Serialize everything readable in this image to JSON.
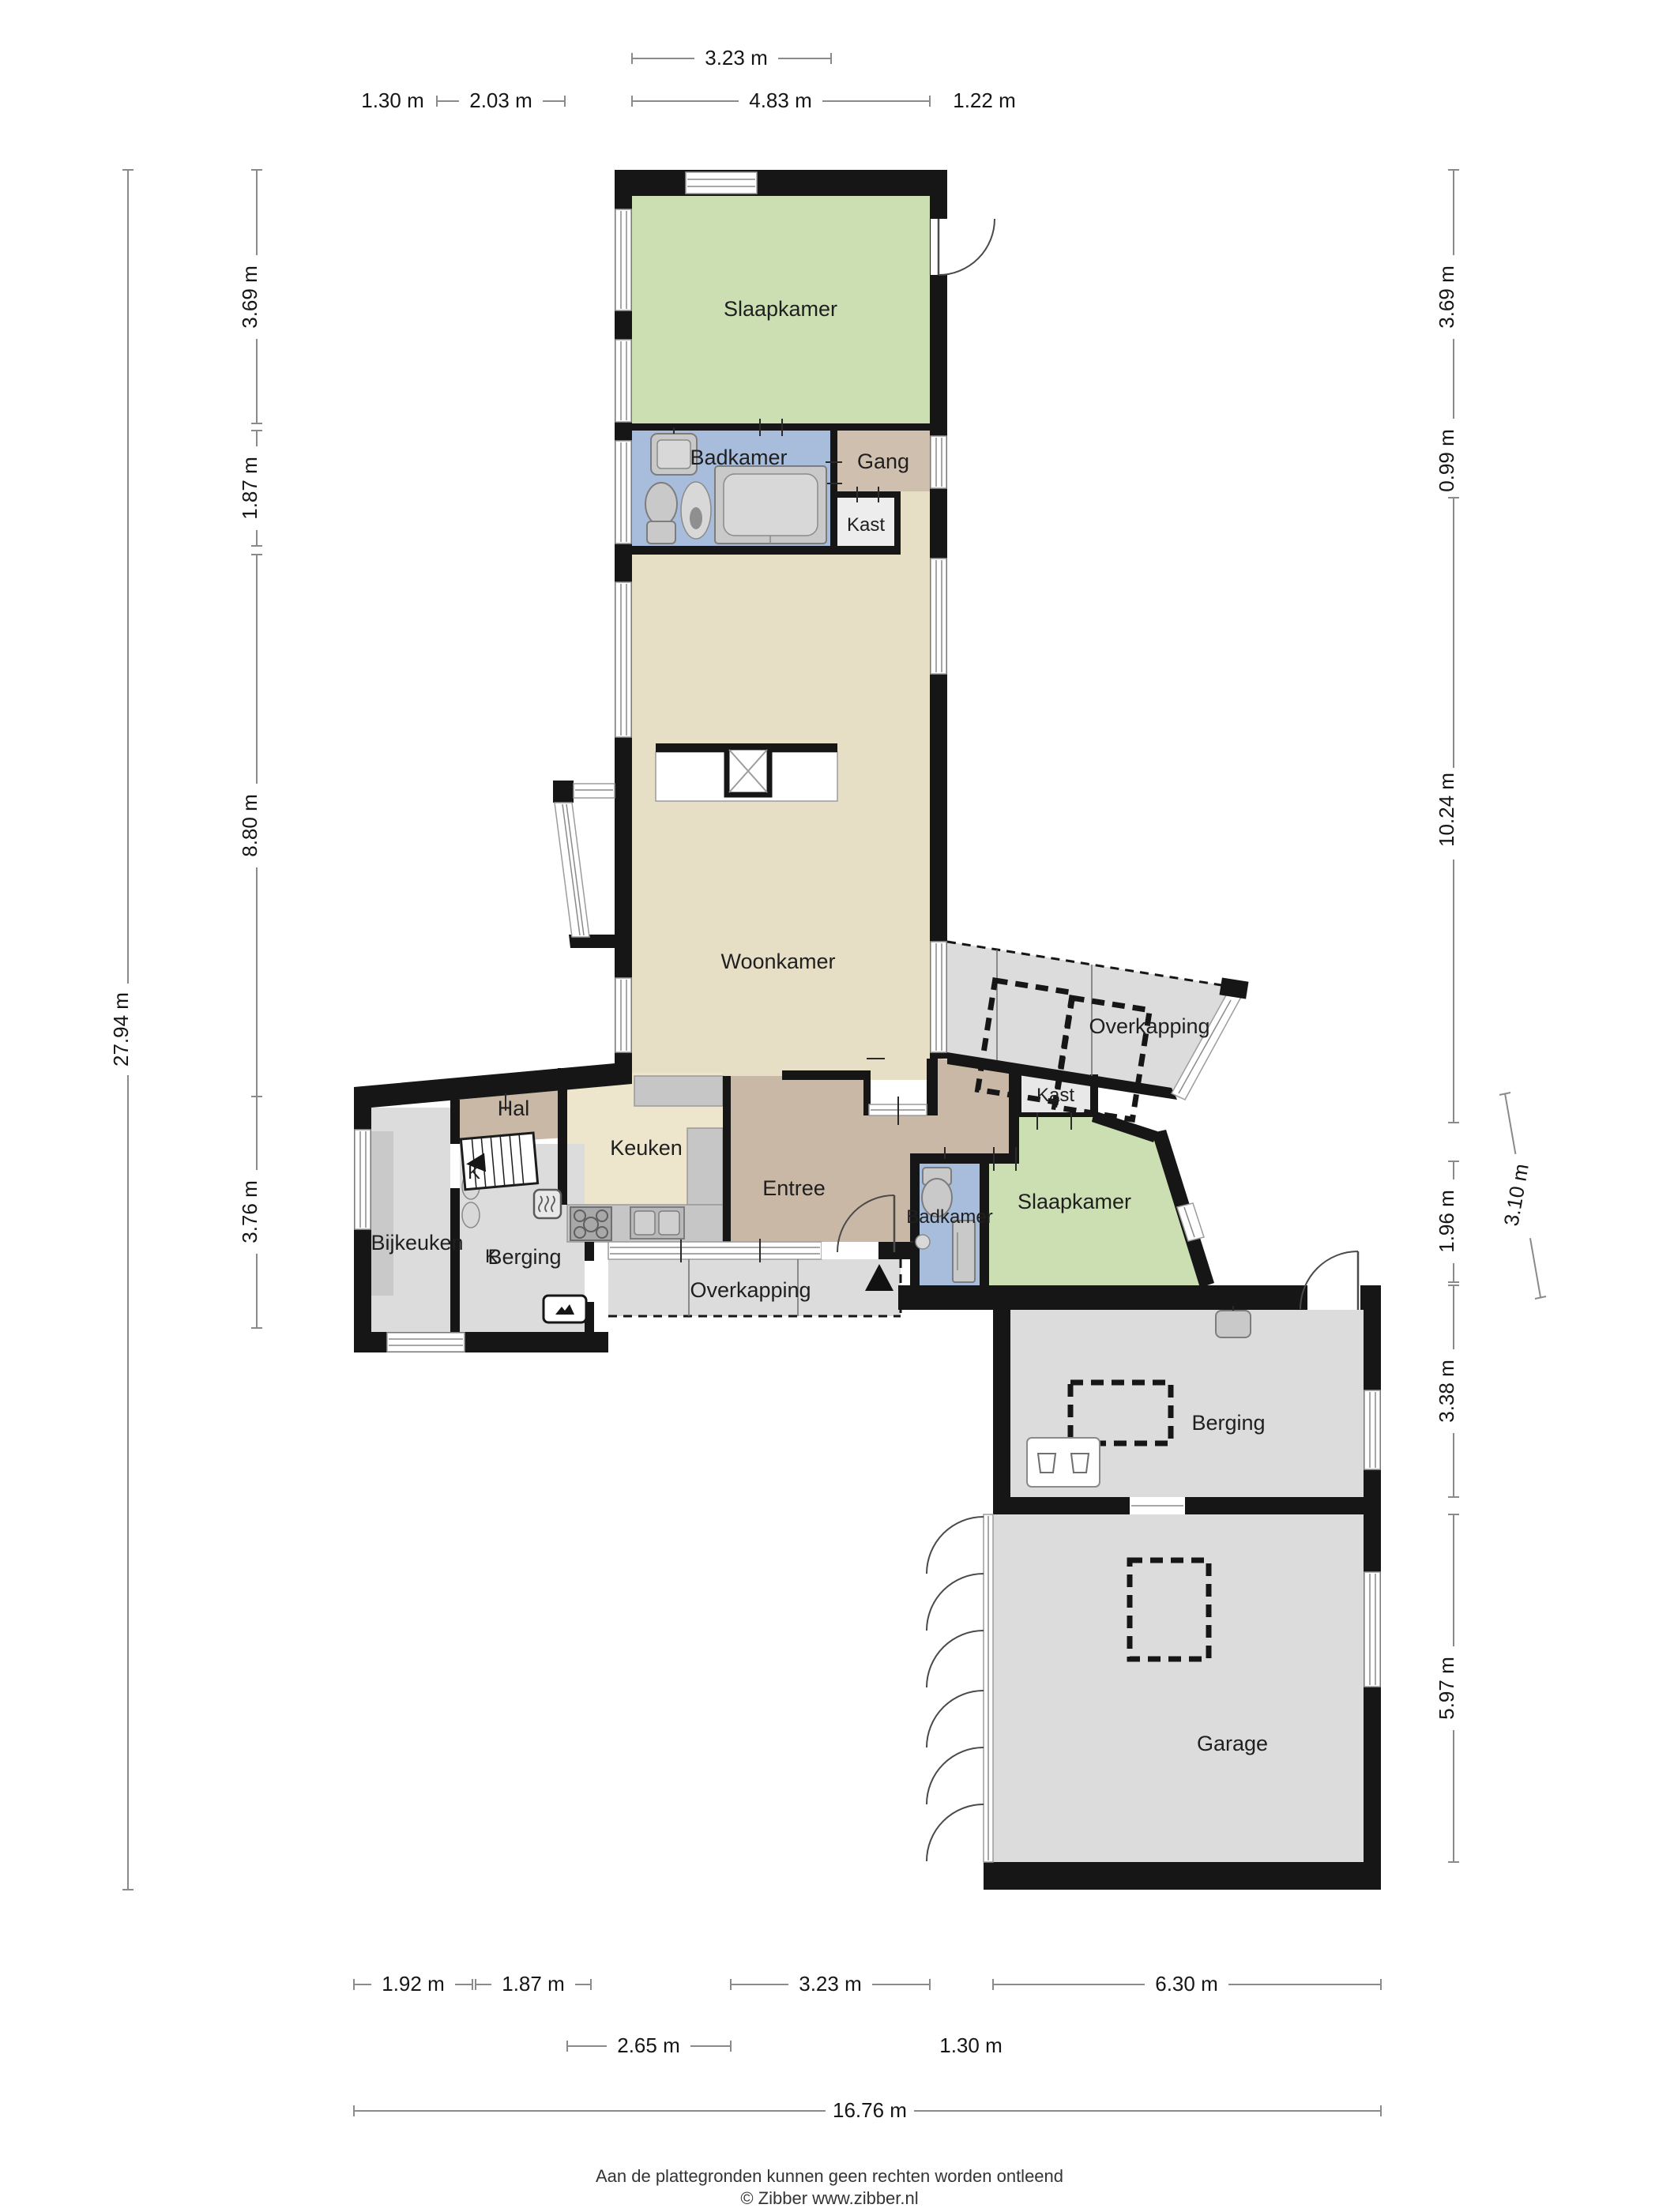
{
  "title": "Floor plan (begane grond) with garage",
  "rooms": {
    "slaapkamer1": "Slaapkamer",
    "badkamer1": "Badkamer",
    "gang": "Gang",
    "kast1": "Kast",
    "woonkamer": "Woonkamer",
    "overkapping_r": "Overkapping",
    "kast2": "Kast",
    "slaapkamer2": "Slaapkamer",
    "badkamer2": "Badkamer",
    "entree": "Entree",
    "keuken": "Keuken",
    "hal": "Hal",
    "k_stairs": "K",
    "k_closet": "K",
    "bijkeuken": "Bijkeuken",
    "berging_s": "Berging",
    "overkapping_b": "Overkapping",
    "berging_l": "Berging",
    "garage": "Garage"
  },
  "dims": {
    "t1": "3.23 m",
    "t2": "1.30 m",
    "t3": "2.03 m",
    "t4": "4.83 m",
    "t5": "1.22 m",
    "l_total": "27.94 m",
    "l1": "3.69 m",
    "l2": "1.87 m",
    "l3": "8.80 m",
    "l4": "3.76 m",
    "r1": "3.69 m",
    "r2": "0.99 m",
    "r3": "10.24 m",
    "r4": "3.10 m",
    "r5": "1.96 m",
    "r6": "3.38 m",
    "r7": "5.97 m",
    "b1": "1.92 m",
    "b2": "1.87 m",
    "b3": "3.23 m",
    "b4": "6.30 m",
    "b5": "2.65 m",
    "b6": "1.30 m",
    "b_total": "16.76 m"
  },
  "footer": {
    "disclaimer": "Aan de plattegronden kunnen geen rechten worden ontleend",
    "credit": "© Zibber www.zibber.nl"
  },
  "colors": {
    "wall": "#161616",
    "bedroom_green": "#cbdfb3",
    "bathroom_blue": "#a7bddb",
    "living_beige": "#e6dfc6",
    "kitchen_cream": "#ede5cc",
    "hall_tan": "#c9b8a6",
    "storage_gray": "#dcdcdc",
    "closet_light": "#ededed",
    "counter_gray": "#c6c6c6",
    "dim_line": "#8a8a8a"
  }
}
